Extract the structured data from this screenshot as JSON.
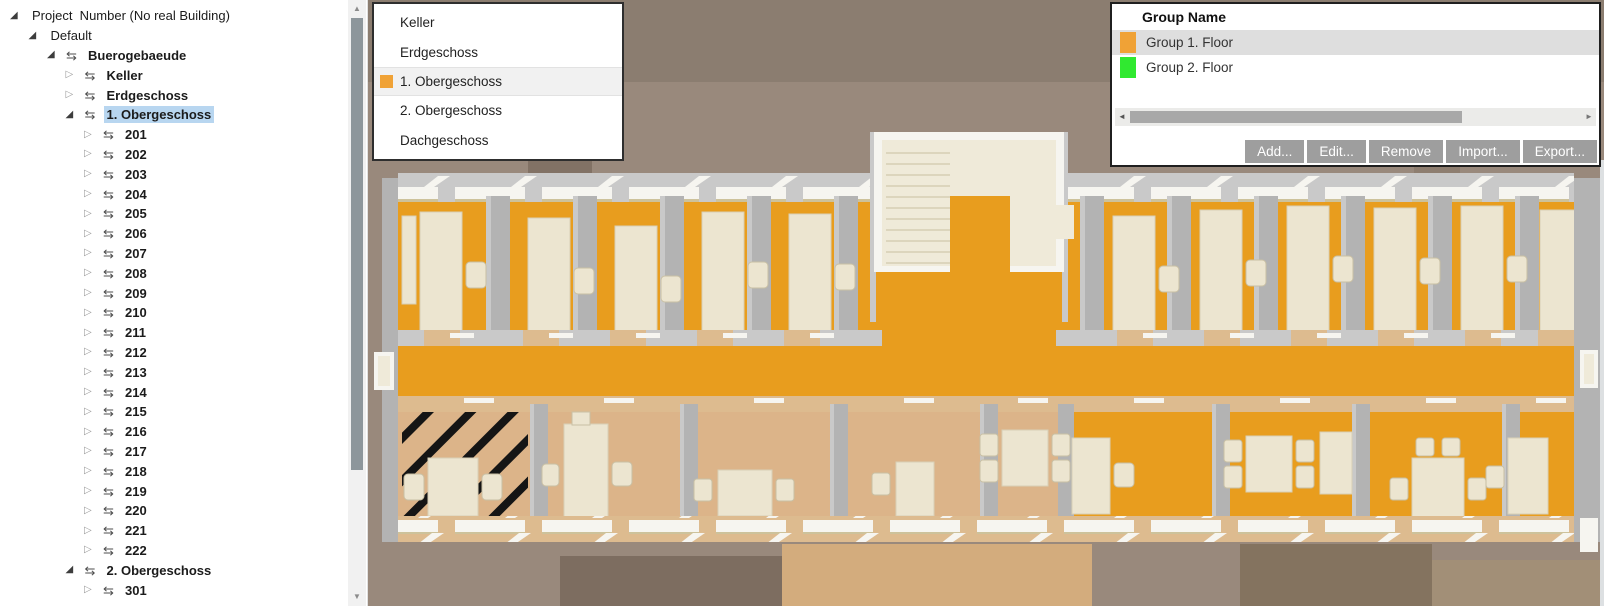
{
  "glyphs": {
    "expanded": "◢",
    "collapsed": "▷",
    "swap": "⇆",
    "scroll_up": "▲",
    "scroll_down": "▼",
    "scroll_left": "◄",
    "scroll_right": "►"
  },
  "tree": {
    "items": [
      {
        "label": "Project  Number (No real Building)",
        "level": 0,
        "state": "expanded",
        "icon": false,
        "bold": false,
        "selected": false
      },
      {
        "label": "Default",
        "level": 1,
        "state": "expanded",
        "icon": false,
        "bold": false,
        "selected": false
      },
      {
        "label": "Buerogebaeude",
        "level": 2,
        "state": "expanded",
        "icon": true,
        "bold": true,
        "selected": false
      },
      {
        "label": "Keller",
        "level": 3,
        "state": "collapsed",
        "icon": true,
        "bold": true,
        "selected": false
      },
      {
        "label": "Erdgeschoss",
        "level": 3,
        "state": "collapsed",
        "icon": true,
        "bold": true,
        "selected": false
      },
      {
        "label": "1. Obergeschoss",
        "level": 3,
        "state": "expanded",
        "icon": true,
        "bold": true,
        "selected": true
      },
      {
        "label": "201",
        "level": 4,
        "state": "collapsed",
        "icon": true,
        "bold": true,
        "selected": false
      },
      {
        "label": "202",
        "level": 4,
        "state": "collapsed",
        "icon": true,
        "bold": true,
        "selected": false
      },
      {
        "label": "203",
        "level": 4,
        "state": "collapsed",
        "icon": true,
        "bold": true,
        "selected": false
      },
      {
        "label": "204",
        "level": 4,
        "state": "collapsed",
        "icon": true,
        "bold": true,
        "selected": false
      },
      {
        "label": "205",
        "level": 4,
        "state": "collapsed",
        "icon": true,
        "bold": true,
        "selected": false
      },
      {
        "label": "206",
        "level": 4,
        "state": "collapsed",
        "icon": true,
        "bold": true,
        "selected": false
      },
      {
        "label": "207",
        "level": 4,
        "state": "collapsed",
        "icon": true,
        "bold": true,
        "selected": false
      },
      {
        "label": "208",
        "level": 4,
        "state": "collapsed",
        "icon": true,
        "bold": true,
        "selected": false
      },
      {
        "label": "209",
        "level": 4,
        "state": "collapsed",
        "icon": true,
        "bold": true,
        "selected": false
      },
      {
        "label": "210",
        "level": 4,
        "state": "collapsed",
        "icon": true,
        "bold": true,
        "selected": false
      },
      {
        "label": "211",
        "level": 4,
        "state": "collapsed",
        "icon": true,
        "bold": true,
        "selected": false
      },
      {
        "label": "212",
        "level": 4,
        "state": "collapsed",
        "icon": true,
        "bold": true,
        "selected": false
      },
      {
        "label": "213",
        "level": 4,
        "state": "collapsed",
        "icon": true,
        "bold": true,
        "selected": false
      },
      {
        "label": "214",
        "level": 4,
        "state": "collapsed",
        "icon": true,
        "bold": true,
        "selected": false
      },
      {
        "label": "215",
        "level": 4,
        "state": "collapsed",
        "icon": true,
        "bold": true,
        "selected": false
      },
      {
        "label": "216",
        "level": 4,
        "state": "collapsed",
        "icon": true,
        "bold": true,
        "selected": false
      },
      {
        "label": "217",
        "level": 4,
        "state": "collapsed",
        "icon": true,
        "bold": true,
        "selected": false
      },
      {
        "label": "218",
        "level": 4,
        "state": "collapsed",
        "icon": true,
        "bold": true,
        "selected": false
      },
      {
        "label": "219",
        "level": 4,
        "state": "collapsed",
        "icon": true,
        "bold": true,
        "selected": false
      },
      {
        "label": "220",
        "level": 4,
        "state": "collapsed",
        "icon": true,
        "bold": true,
        "selected": false
      },
      {
        "label": "221",
        "level": 4,
        "state": "collapsed",
        "icon": true,
        "bold": true,
        "selected": false
      },
      {
        "label": "222",
        "level": 4,
        "state": "collapsed",
        "icon": true,
        "bold": true,
        "selected": false
      },
      {
        "label": "2. Obergeschoss",
        "level": 3,
        "state": "expanded",
        "icon": true,
        "bold": true,
        "selected": false
      },
      {
        "label": "301",
        "level": 4,
        "state": "collapsed",
        "icon": true,
        "bold": true,
        "selected": false
      }
    ]
  },
  "storey_list": {
    "items": [
      {
        "label": "Keller",
        "selected": false
      },
      {
        "label": "Erdgeschoss",
        "selected": false
      },
      {
        "label": "1. Obergeschoss",
        "selected": true,
        "marker_color": "#f0a236"
      },
      {
        "label": "2. Obergeschoss",
        "selected": false
      },
      {
        "label": "Dachgeschoss",
        "selected": false
      }
    ]
  },
  "group_panel": {
    "header": "Group Name",
    "rows": [
      {
        "label": "Group 1. Floor",
        "color": "#f0a236",
        "selected": true
      },
      {
        "label": "Group 2. Floor",
        "color": "#30e930",
        "selected": false
      }
    ],
    "buttons": [
      "Add...",
      "Edit...",
      "Remove",
      "Import...",
      "Export..."
    ]
  },
  "scene": {
    "colors": {
      "bg_top": "#8b7d70",
      "bg_mid": "#99897c",
      "bg_dark": "#7d6d60",
      "bg_terrace": "#d3ac7d",
      "floor_orange": "#e89d1e",
      "floor_tan": "#dcb489",
      "door_tan": "#ddbb8f",
      "wall": "#b3b3b3",
      "wall_light": "#c9c9c9",
      "white": "#f6f5f0",
      "cream": "#ece5d0",
      "stair": "#efead9",
      "hatch": "#151515"
    }
  }
}
